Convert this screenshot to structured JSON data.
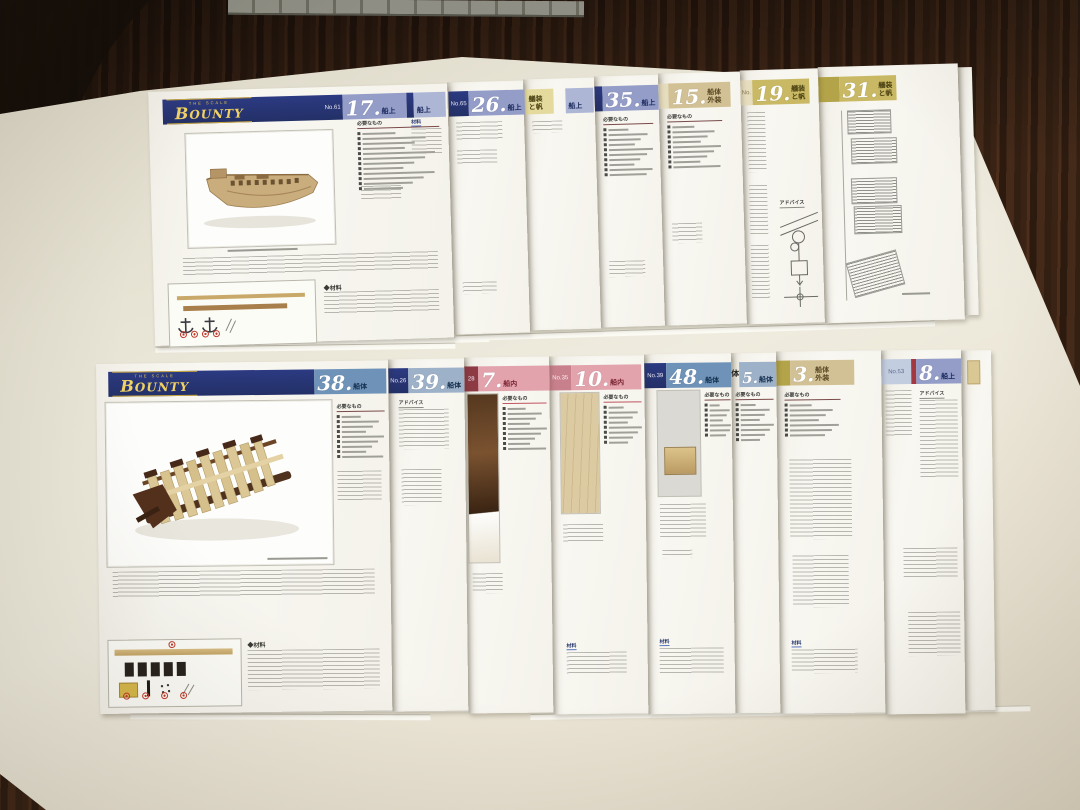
{
  "palette": {
    "navy": "#2c3a82",
    "periwinkle": "#939dc8",
    "olive": "#c9b964",
    "tan": "#d3c196",
    "steel": "#6f93b8",
    "pink": "#e2a3ad",
    "maroon": "#8d3a44",
    "gold": "#f0d264",
    "wood": "#3a2315",
    "table_mat": "#e9e5d6"
  },
  "logo": {
    "top": "THE SCALE",
    "name": "BOUNTY"
  },
  "labels": {
    "needed": "必要なもの",
    "advice": "アドバイス",
    "materials": "材料",
    "materials_sec": "◆材料",
    "partial": "体"
  },
  "top_row": {
    "pages": [
      {
        "no": "No.61",
        "num": "17.",
        "cat": "船上",
        "extra_cat": "船上"
      },
      {
        "no": "No.65",
        "num": "26.",
        "cat": "船上"
      },
      {
        "no": "",
        "num": "",
        "cat": "艤装と帆",
        "extra_cat": "船上"
      },
      {
        "no": "",
        "num": "35.",
        "cat": "船上"
      },
      {
        "no": "",
        "num": "15.",
        "cat": "船体外装"
      },
      {
        "no": "No.",
        "num": "19.",
        "cat": "艤装と帆"
      },
      {
        "no": "",
        "num": "31.",
        "cat": "艤装と帆"
      }
    ]
  },
  "bottom_row": {
    "pages": [
      {
        "no": "",
        "num": "38.",
        "cat": "船体"
      },
      {
        "no": "No.26",
        "num": "39.",
        "cat": "船体"
      },
      {
        "no": "28",
        "num": "7.",
        "cat": "船内"
      },
      {
        "no": "No.35",
        "num": "10.",
        "cat": "船内"
      },
      {
        "no": "No.39",
        "num": "48.",
        "cat": "船体"
      },
      {
        "no": "",
        "num": "5.",
        "cat": "船体",
        "partial": "体"
      },
      {
        "no": "",
        "num": "3.",
        "cat": "船体外装"
      },
      {
        "no": "No.53",
        "num": "8.",
        "cat": "船上"
      }
    ]
  }
}
